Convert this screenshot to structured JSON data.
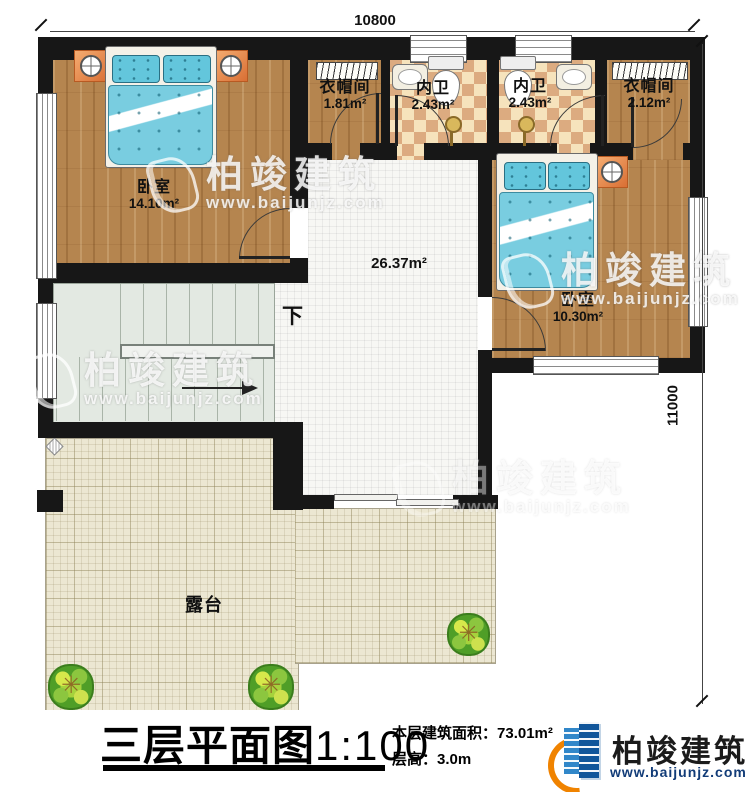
{
  "drawing": {
    "type": "residential floor plan",
    "floor_label": "三层平面图",
    "scale": "1:100"
  },
  "dimensions": {
    "top": "10800",
    "right": "11000"
  },
  "rooms": {
    "bedroom1": {
      "name": "卧室",
      "area": "14.10m²"
    },
    "cloakroom1": {
      "name": "衣帽间",
      "area": "1.81m²"
    },
    "bath1": {
      "name": "内卫",
      "area": "2.43m²"
    },
    "bath2": {
      "name": "内卫",
      "area": "2.43m²"
    },
    "cloakroom2": {
      "name": "衣帽间",
      "area": "2.12m²"
    },
    "bedroom2": {
      "name": "卧室",
      "area": "10.30m²"
    },
    "hall": {
      "area": "26.37m²"
    },
    "stairs": {
      "direction_label": "下"
    },
    "terrace": {
      "name": "露台"
    }
  },
  "title_block": {
    "title": "三层平面图",
    "scale": "1:100",
    "floor_area_label": "本层建筑面积：",
    "floor_area_value": "73.01m²",
    "floor_height_label": "层高：",
    "floor_height_value": "3.0m"
  },
  "brand": {
    "name": "柏竣建筑",
    "website": "www.baijunjz.com"
  },
  "watermark": {
    "name": "柏竣建筑",
    "website": "www.baijunjz.com"
  },
  "colors": {
    "wall": "#171717",
    "wood_floor": "#b5854f",
    "bath_tile_light": "#f6e3bc",
    "bath_tile_dark": "#dcab80",
    "hall_tile": "#f7f7f4",
    "terrace_tile": "#ece7d2",
    "bed_fabric": "#79cde0",
    "nightstand": "#d96f34",
    "plant_green": "#4f9e27",
    "brand_blue": "#11569b",
    "brand_orange": "#f08300"
  }
}
